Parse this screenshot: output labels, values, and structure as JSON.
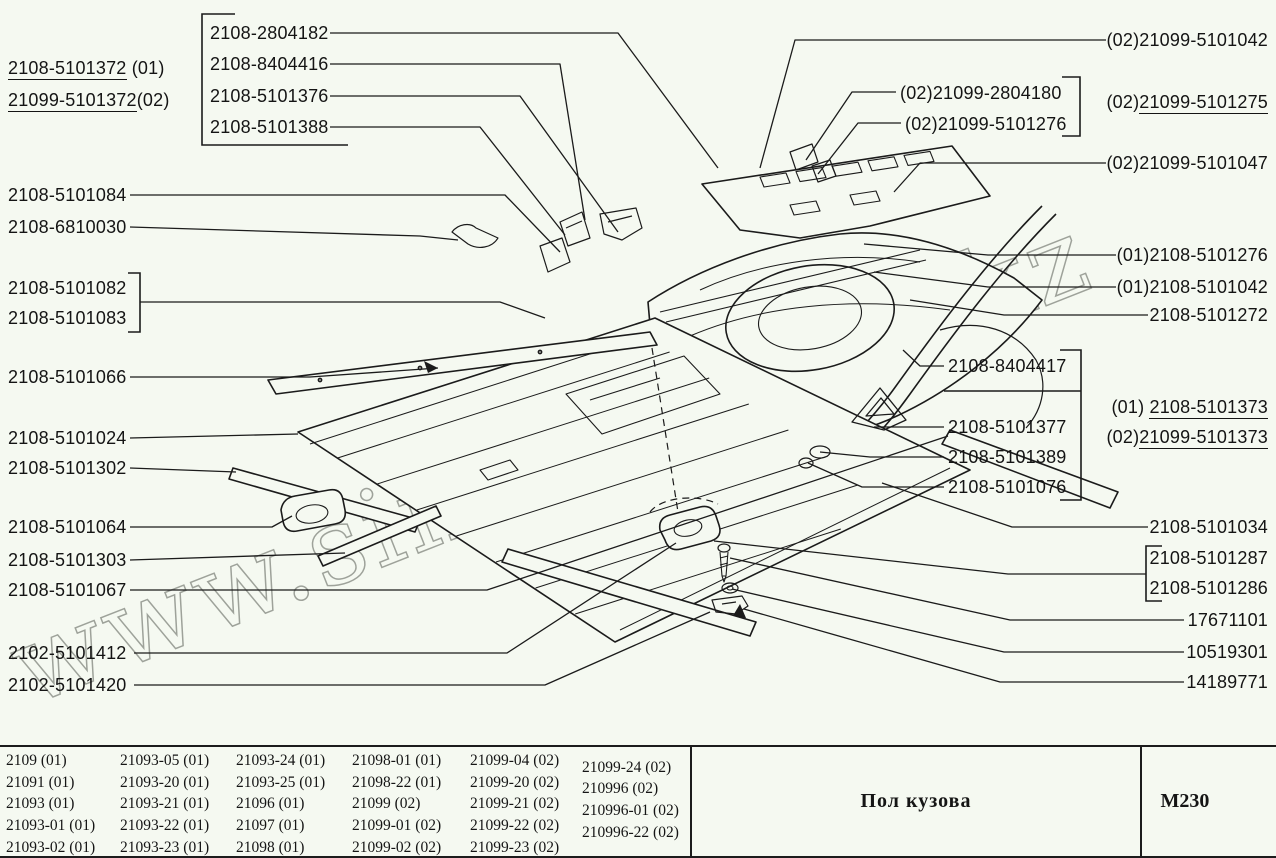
{
  "watermark": {
    "text": "www.sinhron.too.kz"
  },
  "top_left_labels": [
    {
      "num": "2108-5101372",
      "suffix": " (01)"
    },
    {
      "num": "21099-5101372",
      "suffix": "(02)"
    }
  ],
  "box_labels": [
    "2108-2804182",
    "2108-8404416",
    "2108-5101376",
    "2108-5101388"
  ],
  "left_labels": [
    "2108-5101084",
    "2108-6810030",
    "2108-5101082",
    "2108-5101083",
    "2108-5101066",
    "2108-5101024",
    "2108-5101302",
    "2108-5101064",
    "2108-5101303",
    "2108-5101067",
    "2102-5101412",
    "2102-5101420"
  ],
  "right_labels": [
    {
      "prefix": "(02)",
      "num": "21099-5101042"
    },
    {
      "prefix": "(02)",
      "num": "21099-2804180"
    },
    {
      "prefix": "(02)",
      "num": "21099-5101275"
    },
    {
      "prefix": "(02)",
      "num": "21099-5101276"
    },
    {
      "prefix": "(02)",
      "num": "21099-5101047"
    },
    {
      "prefix": "(01)",
      "num": "2108-5101276"
    },
    {
      "prefix": "(01)",
      "num": "2108-5101042"
    },
    {
      "prefix": "",
      "num": "2108-5101272"
    },
    {
      "prefix": "",
      "num": "2108-8404417"
    },
    {
      "prefix": "(01) ",
      "num": "2108-5101373"
    },
    {
      "prefix": "",
      "num": "2108-5101377"
    },
    {
      "prefix": "(02)",
      "num": "21099-5101373"
    },
    {
      "prefix": "",
      "num": "2108-5101389"
    },
    {
      "prefix": "",
      "num": "2108-5101076"
    },
    {
      "prefix": "",
      "num": "2108-5101034"
    },
    {
      "prefix": "",
      "num": "2108-5101287"
    },
    {
      "prefix": "",
      "num": "2108-5101286"
    },
    {
      "prefix": "",
      "num": "17671101"
    },
    {
      "prefix": "",
      "num": "10519301"
    },
    {
      "prefix": "",
      "num": "14189771"
    }
  ],
  "table": {
    "model_columns": [
      [
        "2109 (01)",
        "21091 (01)",
        "21093 (01)",
        "21093-01 (01)",
        "21093-02 (01)"
      ],
      [
        "21093-05 (01)",
        "21093-20 (01)",
        "21093-21 (01)",
        "21093-22 (01)",
        "21093-23 (01)"
      ],
      [
        "21093-24 (01)",
        "21093-25 (01)",
        "21096 (01)",
        "21097 (01)",
        "21098 (01)"
      ],
      [
        "21098-01 (01)",
        "21098-22 (01)",
        "21099 (02)",
        "21099-01 (02)",
        "21099-02 (02)"
      ],
      [
        "21099-04 (02)",
        "21099-20 (02)",
        "21099-21 (02)",
        "21099-22 (02)",
        "21099-23 (02)"
      ],
      [
        "21099-24 (02)",
        "210996 (02)",
        "210996-01 (02)",
        "210996-22 (02)"
      ]
    ],
    "title": "Пол кузова",
    "code": "М230"
  }
}
